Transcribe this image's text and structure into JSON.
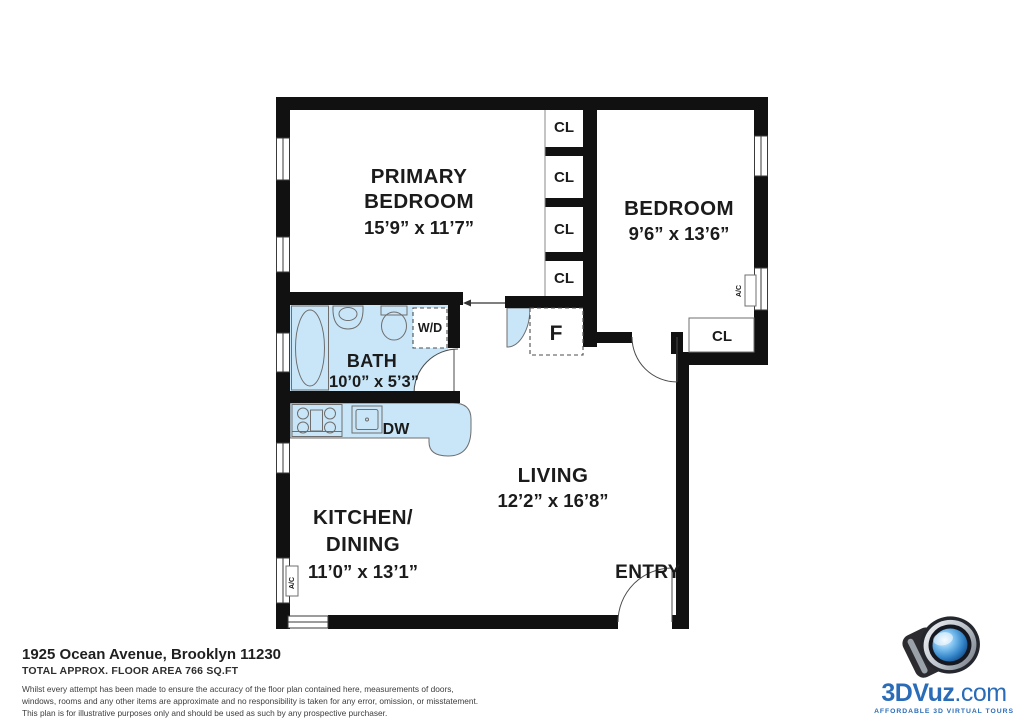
{
  "plan": {
    "rooms": {
      "primary_bedroom": {
        "line1": "PRIMARY",
        "line2": "BEDROOM",
        "dims": "15’9” x 11’7”"
      },
      "bedroom": {
        "label": "BEDROOM",
        "dims": "9’6” x 13’6”"
      },
      "bath": {
        "label": "BATH",
        "dims": "10’0” x 5’3”"
      },
      "kitchen_dining": {
        "line1": "KITCHEN/",
        "line2": "DINING",
        "dims": "11’0” x 13’1”"
      },
      "living": {
        "label": "LIVING",
        "dims": "12’2” x 16’8”"
      },
      "entry": {
        "label": "ENTRY"
      }
    },
    "labels": {
      "closet": "CL",
      "foyer": "F",
      "washer_dryer": "W/D",
      "dishwasher": "DW",
      "ac": "A/C"
    }
  },
  "footer": {
    "address": "1925 Ocean Avenue, Brooklyn 11230",
    "area": "TOTAL APPROX. FLOOR AREA 766 SQ.FT",
    "disclaimer_line1": "Whilst every attempt has been made to ensure the accuracy of the floor plan contained here, measurements of doors,",
    "disclaimer_line2": "windows, rooms and any other items are approximate and no responsibility is taken for any error, omission, or misstatement.",
    "disclaimer_line3": "This plan is for illustrative purposes only and should be used as such by any prospective purchaser."
  },
  "logo": {
    "brand_bold": "3DVuz",
    "brand_suffix": ".com",
    "tagline": "AFFORDABLE 3D VIRTUAL TOURS"
  },
  "colors": {
    "wall": "#111111",
    "fixture_fill": "#c9e6f8",
    "fixture_stroke": "#6e6e6e",
    "logo_blue": "#2a6cb8"
  }
}
